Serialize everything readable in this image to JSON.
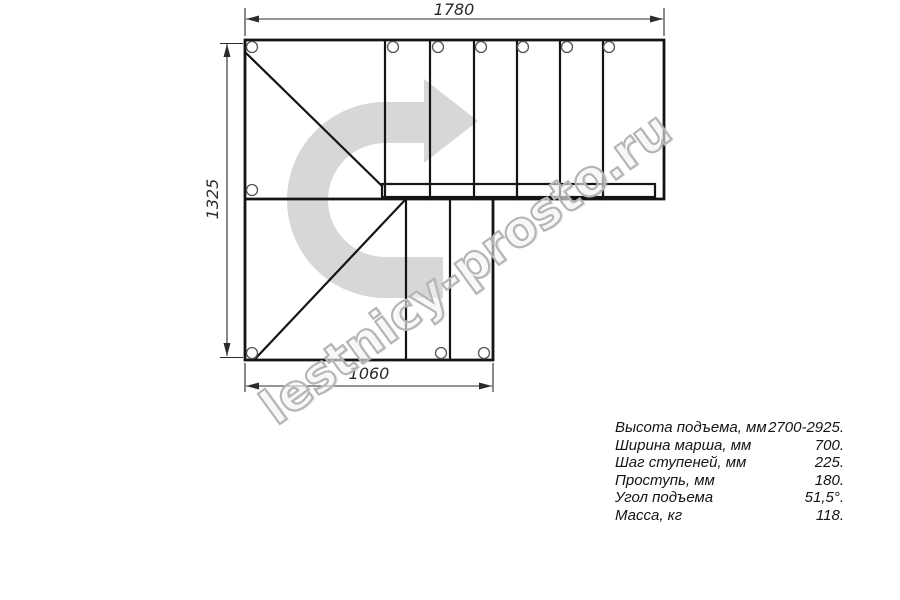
{
  "title": "Staircase plan drawing",
  "dimensions": {
    "top": "1780",
    "left": "1325",
    "bottom": "1060"
  },
  "specs": {
    "rows": [
      {
        "label": "Высота подъема, мм",
        "value": "2700-2925."
      },
      {
        "label": "Ширина марша, мм",
        "value": "700."
      },
      {
        "label": "Шаг ступеней, мм",
        "value": "225."
      },
      {
        "label": "Проступь, мм",
        "value": "180."
      },
      {
        "label": "Угол подъема",
        "value": "51,5°."
      },
      {
        "label": "Масса, кг",
        "value": "118."
      }
    ]
  },
  "watermark": {
    "text": "lestnicy-prosto.ru"
  },
  "icons": {
    "direction_arrow": "curved-arrow-right"
  },
  "colors": {
    "line": "#141414",
    "dim": "#2b2b2b",
    "bolt": "#555555",
    "arrow": "#d7d7d7",
    "watermark": "#b5b5b5"
  }
}
